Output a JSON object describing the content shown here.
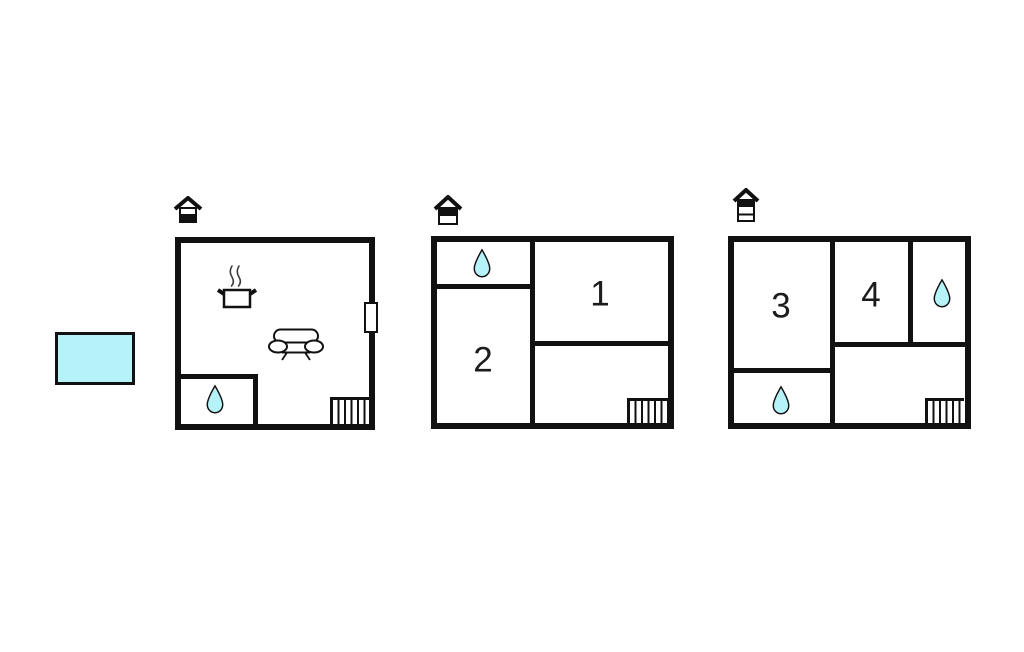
{
  "page": {
    "background": "#ffffff",
    "type": "property-floor-plan"
  },
  "colors": {
    "wall": "#111111",
    "water": "#b5f3f8",
    "line": "#111111"
  },
  "pool": {
    "icon": "swimming-pool",
    "color": "#b5f3f8"
  },
  "floors": [
    {
      "name": "ground-floor",
      "icon": "house-ground-floor-icon",
      "rooms": [],
      "features": [
        "cooking-pot-icon",
        "sofa-icon",
        "water-drop-icon",
        "stairs",
        "door-window"
      ]
    },
    {
      "name": "first-floor",
      "icon": "house-upper-floor-icon",
      "rooms": [
        {
          "label": "1"
        },
        {
          "label": "2"
        }
      ],
      "features": [
        "water-drop-icon",
        "stairs"
      ]
    },
    {
      "name": "second-floor",
      "icon": "house-top-floor-icon",
      "rooms": [
        {
          "label": "3"
        },
        {
          "label": "4"
        }
      ],
      "features": [
        "water-drop-icon",
        "water-drop-icon",
        "stairs"
      ]
    }
  ]
}
